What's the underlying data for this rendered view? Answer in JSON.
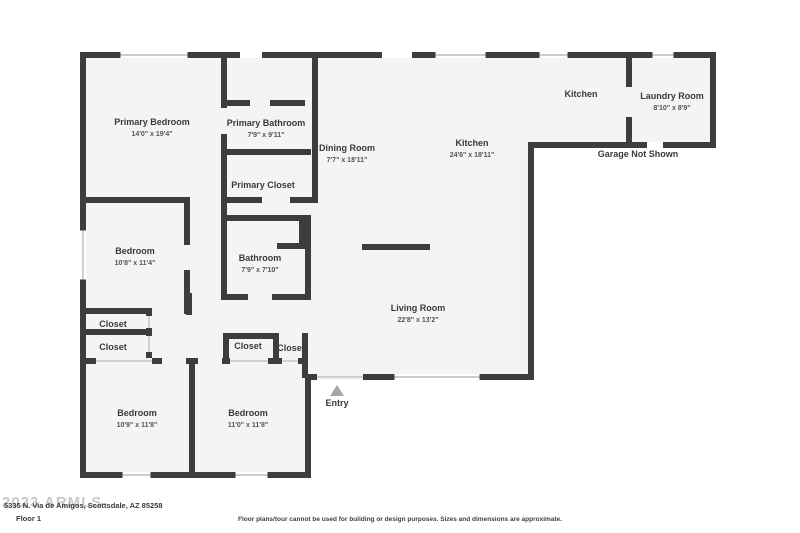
{
  "colors": {
    "wall": "#3d3d3d",
    "floor": "#f4f4f4",
    "window_line": "#bcbcbc",
    "thin_line": "#c4c4c4",
    "label": "#3a3a3a",
    "dim": "#555555",
    "entry_arrow": "#a6a6a6"
  },
  "footer": {
    "watermark": "2023 ARMLS",
    "address": "5335 N. Via de Amigos, Scottsdale, AZ 85258",
    "floor_label": "Floor 1",
    "disclaimer": "Floor plans/tour cannot be used for building or design purposes. Sizes and dimensions are approximate."
  },
  "floorplan": {
    "outline_points": "80,52 716,52 716,148 534,148 534,380 311,380 311,478 80,478",
    "walls": [
      [
        80,
        52,
        636,
        6
      ],
      [
        710,
        52,
        6,
        96
      ],
      [
        534,
        142,
        182,
        6
      ],
      [
        528,
        142,
        6,
        238
      ],
      [
        305,
        374,
        229,
        6
      ],
      [
        305,
        374,
        6,
        104
      ],
      [
        80,
        472,
        231,
        6
      ],
      [
        80,
        52,
        6,
        426
      ],
      [
        221,
        52,
        6,
        56
      ],
      [
        221,
        134,
        6,
        66
      ],
      [
        227,
        100,
        23,
        6
      ],
      [
        270,
        100,
        35,
        6
      ],
      [
        227,
        149,
        84,
        6
      ],
      [
        80,
        197,
        110,
        6
      ],
      [
        221,
        197,
        41,
        6
      ],
      [
        290,
        197,
        28,
        6
      ],
      [
        312,
        52,
        6,
        150
      ],
      [
        184,
        197,
        6,
        48
      ],
      [
        184,
        270,
        6,
        44
      ],
      [
        227,
        215,
        84,
        6
      ],
      [
        277,
        243,
        28,
        6
      ],
      [
        299,
        221,
        6,
        28
      ],
      [
        305,
        215,
        6,
        85
      ],
      [
        221,
        203,
        6,
        97
      ],
      [
        221,
        294,
        27,
        6
      ],
      [
        272,
        294,
        39,
        6
      ],
      [
        80,
        308,
        72,
        6
      ],
      [
        80,
        329,
        72,
        6
      ],
      [
        146,
        308,
        6,
        56
      ],
      [
        186,
        293,
        6,
        22
      ],
      [
        223,
        333,
        56,
        6
      ],
      [
        223,
        333,
        6,
        27
      ],
      [
        273,
        333,
        6,
        27
      ],
      [
        302,
        333,
        6,
        45
      ],
      [
        80,
        358,
        16,
        6
      ],
      [
        152,
        358,
        10,
        6
      ],
      [
        186,
        358,
        12,
        6
      ],
      [
        222,
        358,
        8,
        6
      ],
      [
        268,
        358,
        14,
        6
      ],
      [
        298,
        358,
        10,
        6
      ],
      [
        189,
        364,
        6,
        114
      ],
      [
        626,
        52,
        6,
        35
      ],
      [
        626,
        117,
        6,
        31
      ]
    ],
    "island": [
      362,
      244,
      68,
      6
    ],
    "windows": [
      {
        "x": 118,
        "y": 52,
        "w": 72,
        "h": 6,
        "type": "double"
      },
      {
        "x": 433,
        "y": 52,
        "w": 55,
        "h": 6,
        "type": "double"
      },
      {
        "x": 537,
        "y": 52,
        "w": 33,
        "h": 6,
        "type": "double"
      },
      {
        "x": 650,
        "y": 52,
        "w": 26,
        "h": 6,
        "type": "double"
      },
      {
        "x": 80,
        "y": 228,
        "w": 6,
        "h": 54,
        "type": "double"
      },
      {
        "x": 120,
        "y": 472,
        "w": 33,
        "h": 6,
        "type": "double"
      },
      {
        "x": 233,
        "y": 472,
        "w": 37,
        "h": 6,
        "type": "double"
      },
      {
        "x": 392,
        "y": 374,
        "w": 90,
        "h": 6,
        "type": "double"
      },
      {
        "x": 240,
        "y": 52,
        "w": 22,
        "h": 6,
        "type": "gap"
      },
      {
        "x": 382,
        "y": 52,
        "w": 30,
        "h": 6,
        "type": "gap"
      },
      {
        "x": 647,
        "y": 142,
        "w": 16,
        "h": 6,
        "type": "gap"
      },
      {
        "x": 317,
        "y": 374,
        "w": 46,
        "h": 6,
        "type": "thin"
      },
      {
        "x": 96,
        "y": 358,
        "w": 56,
        "h": 6,
        "type": "thin"
      },
      {
        "x": 230,
        "y": 358,
        "w": 38,
        "h": 6,
        "type": "thin"
      },
      {
        "x": 282,
        "y": 358,
        "w": 16,
        "h": 6,
        "type": "thin"
      },
      {
        "x": 146,
        "y": 316,
        "w": 6,
        "h": 12,
        "type": "thin"
      },
      {
        "x": 146,
        "y": 336,
        "w": 6,
        "h": 16,
        "type": "thin"
      }
    ],
    "rooms": [
      {
        "id": "primary-bedroom",
        "name": "Primary Bedroom",
        "dims": "14'0\" x 19'4\"",
        "cx": 152,
        "cy": 125
      },
      {
        "id": "primary-bathroom",
        "name": "Primary Bathroom",
        "dims": "7'9\" x 9'11\"",
        "cx": 266,
        "cy": 126
      },
      {
        "id": "primary-closet",
        "name": "Primary Closet",
        "dims": "",
        "cx": 263,
        "cy": 188
      },
      {
        "id": "dining-room",
        "name": "Dining Room",
        "dims": "7'7\" x 18'11\"",
        "cx": 347,
        "cy": 151
      },
      {
        "id": "kitchen",
        "name": "Kitchen",
        "dims": "24'6\" x 18'11\"",
        "cx": 472,
        "cy": 146
      },
      {
        "id": "kitchen-area",
        "name": "Kitchen",
        "dims": "",
        "cx": 581,
        "cy": 97
      },
      {
        "id": "laundry-room",
        "name": "Laundry Room",
        "dims": "8'10\" x 8'9\"",
        "cx": 672,
        "cy": 99
      },
      {
        "id": "bedroom-left",
        "name": "Bedroom",
        "dims": "10'8\" x 11'4\"",
        "cx": 135,
        "cy": 254
      },
      {
        "id": "bathroom",
        "name": "Bathroom",
        "dims": "7'9\" x 7'10\"",
        "cx": 260,
        "cy": 261
      },
      {
        "id": "living-room",
        "name": "Living Room",
        "dims": "22'8\" x 13'2\"",
        "cx": 418,
        "cy": 311
      },
      {
        "id": "bedroom-bottom-left",
        "name": "Bedroom",
        "dims": "10'9\" x 11'8\"",
        "cx": 137,
        "cy": 416
      },
      {
        "id": "bedroom-bottom-middle",
        "name": "Bedroom",
        "dims": "11'0\" x 11'8\"",
        "cx": 248,
        "cy": 416
      },
      {
        "id": "closet-1",
        "name": "Closet",
        "dims": "",
        "cx": 113,
        "cy": 327
      },
      {
        "id": "closet-2",
        "name": "Closet",
        "dims": "",
        "cx": 113,
        "cy": 350
      },
      {
        "id": "closet-3",
        "name": "Closet",
        "dims": "",
        "cx": 248,
        "cy": 349
      },
      {
        "id": "closet-4",
        "name": "Closet",
        "dims": "",
        "cx": 291,
        "cy": 351
      },
      {
        "id": "garage-note",
        "name": "Garage Not Shown",
        "dims": "",
        "cx": 638,
        "cy": 157
      }
    ],
    "entry": {
      "label": "Entry",
      "label_cx": 337,
      "label_cy": 406,
      "arrow_points": "330,396 344,396 337,385"
    }
  }
}
